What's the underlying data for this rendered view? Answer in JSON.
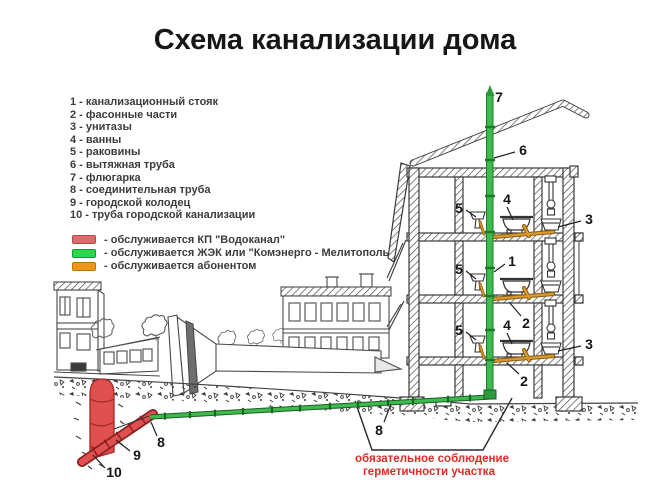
{
  "slide": {
    "title": "Схема канализации дома",
    "background": "#ffffff"
  },
  "legend": {
    "items": [
      "1 - канализационный стояк",
      "2 - фасонные части",
      "3 - унитазы",
      "4 - ванны",
      "5 - раковины",
      "6 - вытяжная труба",
      "7 - флюгарка",
      "8 - соединительная труба",
      "9 - городской колодец",
      "10 - труба городской канализации"
    ]
  },
  "service_legend": {
    "items": [
      {
        "color": "#d96b6b",
        "border": "#b4483f",
        "label": "- обслуживается КП \"Водоканал\""
      },
      {
        "color": "#2fd54b",
        "border": "#169a2b",
        "label": "- обслуживается ЖЭК или \"Комэнерго - Мелитополь\""
      },
      {
        "color": "#ec9517",
        "border": "#bf7410",
        "label": "- обслуживается абонентом"
      }
    ]
  },
  "diagram": {
    "labels": [
      {
        "text": "7"
      },
      {
        "text": "6"
      },
      {
        "text": "5"
      },
      {
        "text": "4"
      },
      {
        "text": "3"
      },
      {
        "text": "1"
      },
      {
        "text": "5"
      },
      {
        "text": "2"
      },
      {
        "text": "5"
      },
      {
        "text": "4"
      },
      {
        "text": "3"
      },
      {
        "text": "2"
      },
      {
        "text": "8"
      },
      {
        "text": "8"
      },
      {
        "text": "9"
      },
      {
        "text": "10"
      }
    ],
    "note": {
      "line1": "обязательное соблюдение",
      "line2": "герметичности участка",
      "color": "#de2b24"
    },
    "colors": {
      "stack_pipe": "#3dbb4d",
      "connection_pipe": "#3dbb4d",
      "floor_pipes": "#d99a2e",
      "city_well": "#e05050",
      "city_pipe": "#e05050"
    }
  }
}
